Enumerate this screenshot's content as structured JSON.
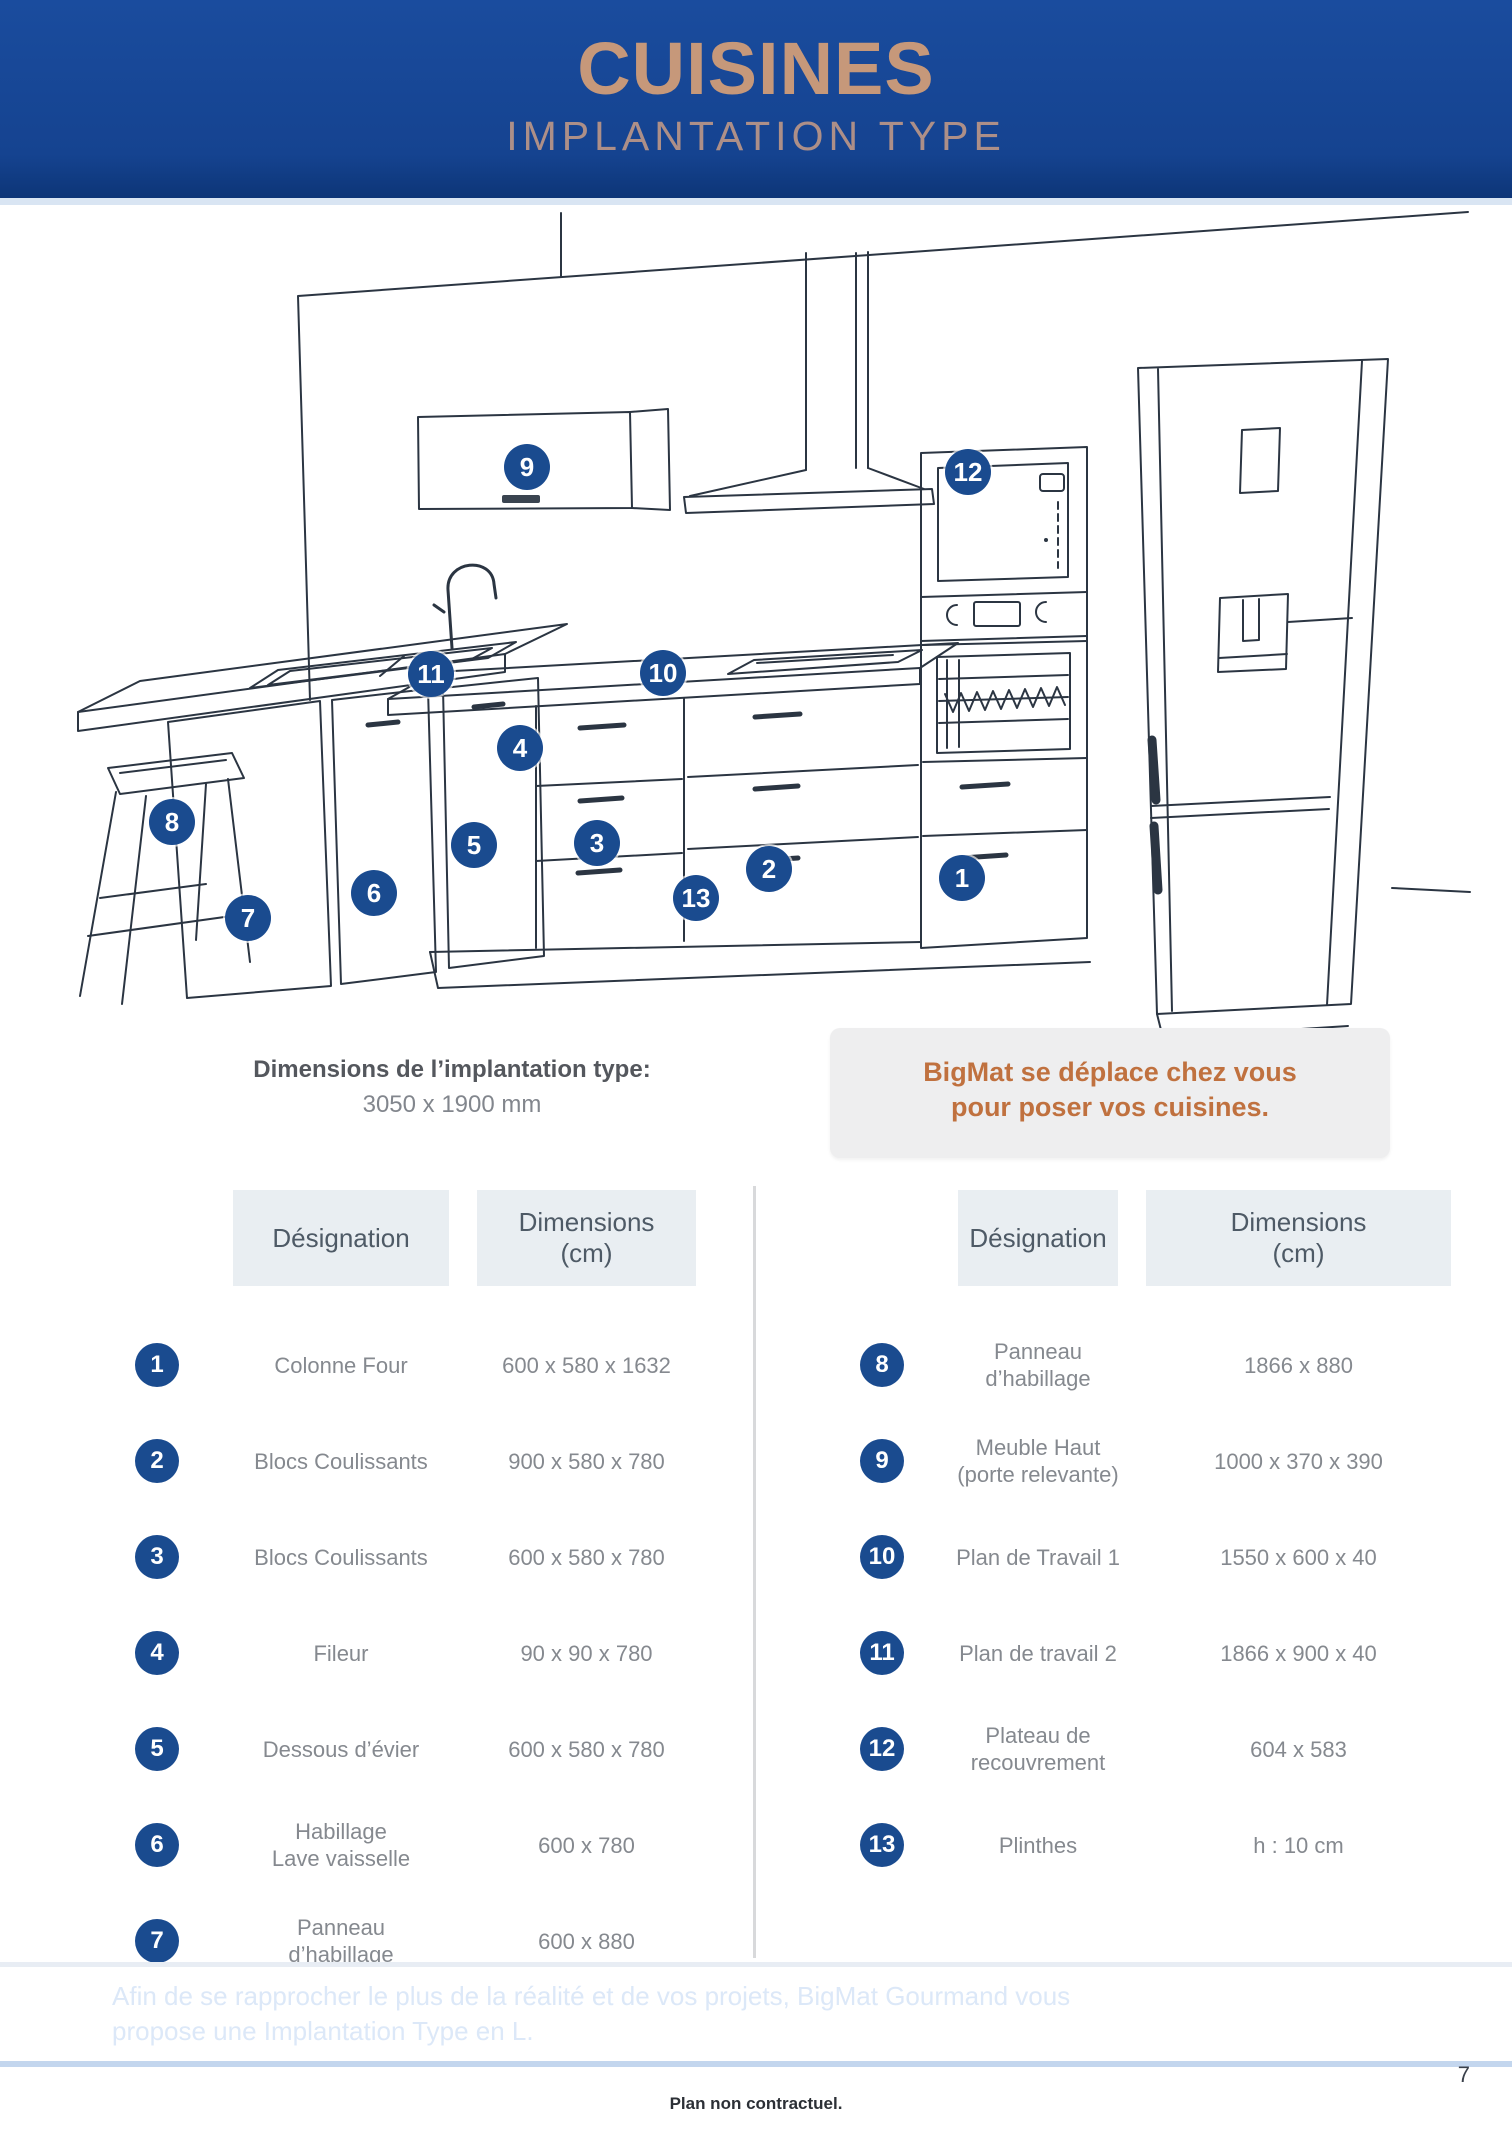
{
  "header": {
    "title": "CUISINES",
    "subtitle": "IMPLANTATION TYPE"
  },
  "illustration": {
    "callouts": [
      {
        "n": "1"
      },
      {
        "n": "2"
      },
      {
        "n": "3"
      },
      {
        "n": "4"
      },
      {
        "n": "5"
      },
      {
        "n": "6"
      },
      {
        "n": "7"
      },
      {
        "n": "8"
      },
      {
        "n": "9"
      },
      {
        "n": "10"
      },
      {
        "n": "11"
      },
      {
        "n": "12"
      },
      {
        "n": "13"
      }
    ],
    "dimensions_label": "Dimensions de l’implantation type:",
    "dimensions_value": "3050 x 1900 mm",
    "promo_line1": "BigMat se déplace chez vous",
    "promo_line2": "pour poser vos cuisines."
  },
  "tables": {
    "left": {
      "headers": {
        "designation": "Désignation",
        "dimensions": "Dimensions\n(cm)"
      },
      "rows": [
        {
          "num": "1",
          "designation": "Colonne Four",
          "dimensions": "600 x 580 x 1632"
        },
        {
          "num": "2",
          "designation": "Blocs Coulissants",
          "dimensions": "900 x 580 x 780"
        },
        {
          "num": "3",
          "designation": "Blocs Coulissants",
          "dimensions": "600 x 580 x 780"
        },
        {
          "num": "4",
          "designation": "Fileur",
          "dimensions": "90 x 90 x 780"
        },
        {
          "num": "5",
          "designation": "Dessous d’évier",
          "dimensions": "600 x 580 x 780"
        },
        {
          "num": "6",
          "designation": "Habillage\nLave vaisselle",
          "dimensions": "600 x 780"
        },
        {
          "num": "7",
          "designation": "Panneau\nd’habillage",
          "dimensions": "600 x 880"
        }
      ]
    },
    "right": {
      "headers": {
        "designation": "Désignation",
        "dimensions": "Dimensions\n(cm)"
      },
      "rows": [
        {
          "num": "8",
          "designation": "Panneau\nd’habillage",
          "dimensions": "1866 x 880"
        },
        {
          "num": "9",
          "designation": "Meuble Haut\n(porte relevante)",
          "dimensions": "1000 x 370 x 390"
        },
        {
          "num": "10",
          "designation": "Plan de Travail 1",
          "dimensions": "1550 x 600 x 40"
        },
        {
          "num": "11",
          "designation": "Plan de travail 2",
          "dimensions": "1866 x 900 x 40"
        },
        {
          "num": "12",
          "designation": "Plateau de\nrecouvrement",
          "dimensions": "604 x 583"
        },
        {
          "num": "13",
          "designation": "Plinthes",
          "dimensions": "h : 10 cm"
        }
      ]
    }
  },
  "footer": {
    "banner_line1": "Afin de se rapprocher le plus de la réalité et de vos projets, BigMat Gourmand vous",
    "banner_line2": "propose une Implantation Type en L.",
    "page_number": "7",
    "note": "Plan non contractuel."
  },
  "colors": {
    "brand_blue": "#15439b",
    "title_tan": "#c6987a",
    "callout_blue": "#1a4b8f",
    "accent_orange": "#c0713f",
    "table_header_bg": "#e9eef2",
    "body_text_gray": "#85898f",
    "light_strip_blue": "#d9e5f3"
  }
}
